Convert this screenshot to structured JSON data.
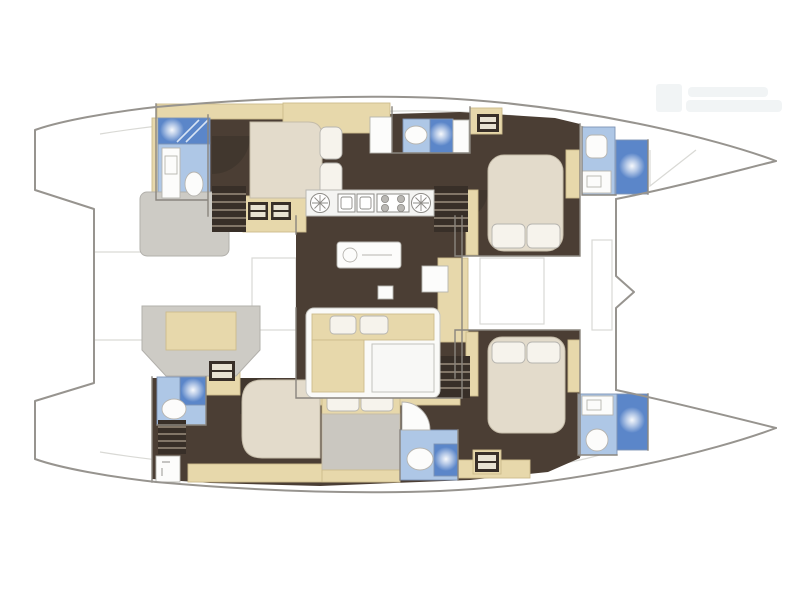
{
  "meta": {
    "title": "Catamaran interior floorplan",
    "view": "top-down",
    "bow_direction": "right"
  },
  "palette": {
    "hull_outline": "#97948f",
    "deck_line": "#d9d9d5",
    "wall": "#8a857e",
    "floor": "#4b3e34",
    "floor_shade": "#382f28",
    "cabinet": "#e7d8ab",
    "bath_floor": "#aec7e6",
    "shower": "#5b86c9",
    "fixture": "#fcfcfb",
    "bed": "#e3dbcb",
    "pillow": "#f6f3ec",
    "blanket": "#cac7c0",
    "module": "#cdcbc5",
    "galley": "#f4f4f2",
    "sofa": "#fafaf8",
    "table": "#f8f8f6",
    "watermark": "#e9edf0"
  },
  "diagram": {
    "kind": "floorplan",
    "vessel": "sailing catamaran",
    "hulls": 2,
    "counts": {
      "double_berths": 5,
      "wet_rooms": 6,
      "shower_units": 6,
      "toilets": 6,
      "staircases": 4,
      "galley_burners": 4,
      "galley_sinks": 2
    },
    "areas": {
      "port_hull": [
        "aft head with shower",
        "aft double cabin",
        "mid head with shower",
        "forward double cabin",
        "forward head with shower"
      ],
      "starboard_hull": [
        "aft head with shower",
        "aft double cabin",
        "mid double berth",
        "mid head with shower",
        "forward double cabin",
        "forward head with shower"
      ],
      "bridgedeck": [
        "galley with sinks and stove",
        "island counter",
        "salon sofa with coffee table",
        "nav station",
        "aft cockpit bench",
        "forward cockpit"
      ]
    },
    "watermark_legible": false
  }
}
